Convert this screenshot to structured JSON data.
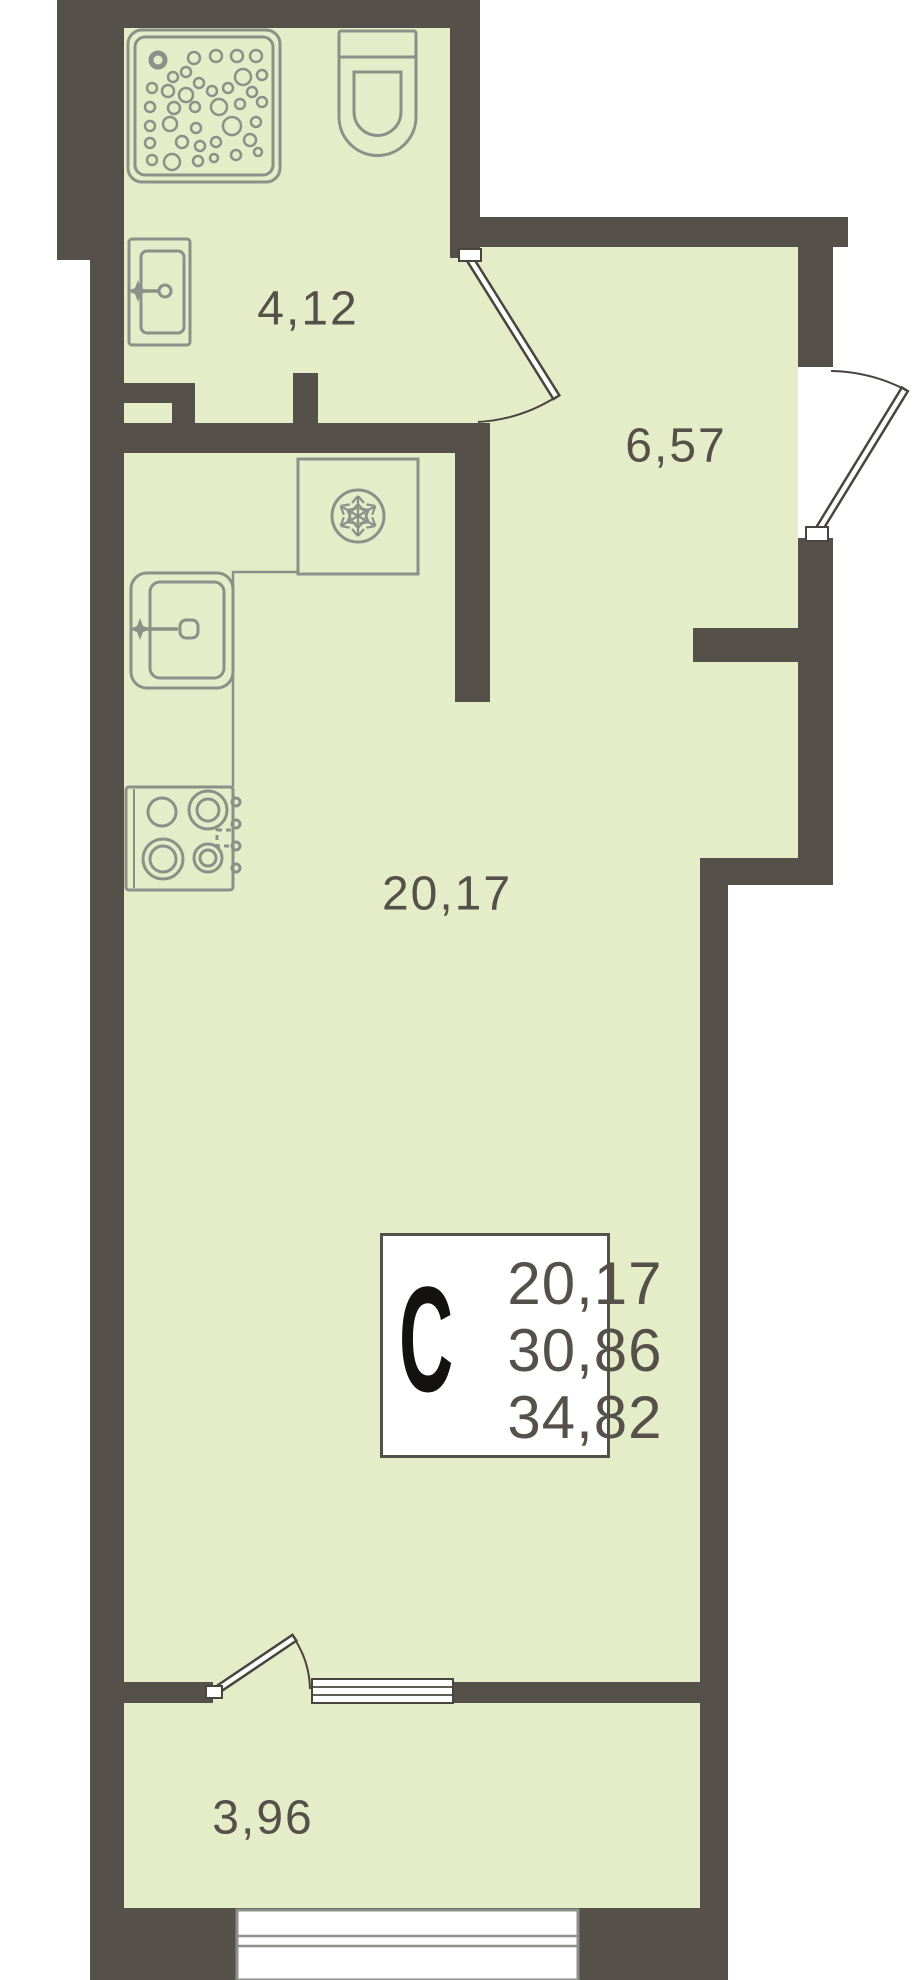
{
  "colors": {
    "wall": "#56504a",
    "floor": "#e4edc7",
    "fixture": "#8b9089",
    "door": "#4a443f",
    "label": "#55504a",
    "letter": "#141210"
  },
  "rooms": {
    "bathroom": {
      "area": "4,12"
    },
    "hallway": {
      "area": "6,57"
    },
    "living": {
      "area": "20,17"
    },
    "balcony": {
      "area": "3,96"
    }
  },
  "summary": {
    "type_letter": "С",
    "lines": [
      "20,17",
      "30,86",
      "34,82"
    ]
  }
}
